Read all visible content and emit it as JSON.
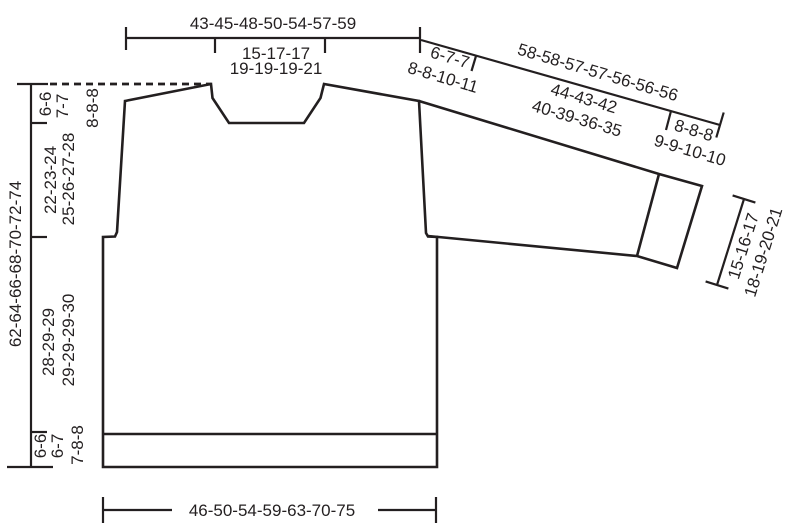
{
  "diagram": {
    "kind": "knitting-pattern-measurement-schematic",
    "garment": "drop-shoulder sweater with ribbed hem and cuffs",
    "sizes_shown": 7,
    "colors": {
      "ink": "#231f20",
      "background": "#ffffff"
    }
  },
  "labels": {
    "chest_width": "43-45-48-50-54-57-59",
    "neck_width_l1": "15-17-17",
    "neck_width_l2": "19-19-19-21",
    "shoulder_width_l1": "6-7-7",
    "shoulder_width_l2": "8-8-10-11",
    "sleeve_total_length": "58-58-57-57-56-56-56",
    "sleeve_seam_l1": "44-43-42",
    "sleeve_seam_l2": "40-39-36-35",
    "cuff_length_l1": "8-8-8",
    "cuff_length_l2": "9-9-10-10",
    "cuff_width_l1": "15-16-17",
    "cuff_width_l2": "18-19-20-21",
    "neck_rib_height_l1": "6-6",
    "neck_rib_height_l2": "7-7",
    "neck_rib_height_l3": "8-8-8",
    "yoke_height_l1": "22-23-24",
    "yoke_height_l2": "25-26-27-28",
    "total_length": "62-64-66-68-70-72-74",
    "body_height_l1": "28-29-29",
    "body_height_l2": "29-29-29-30",
    "hem_rib_height_l1": "6-6",
    "hem_rib_height_l2": "6-7",
    "hem_rib_height_l3": "7-8-8",
    "hem_width": "46-50-54-59-63-70-75"
  }
}
